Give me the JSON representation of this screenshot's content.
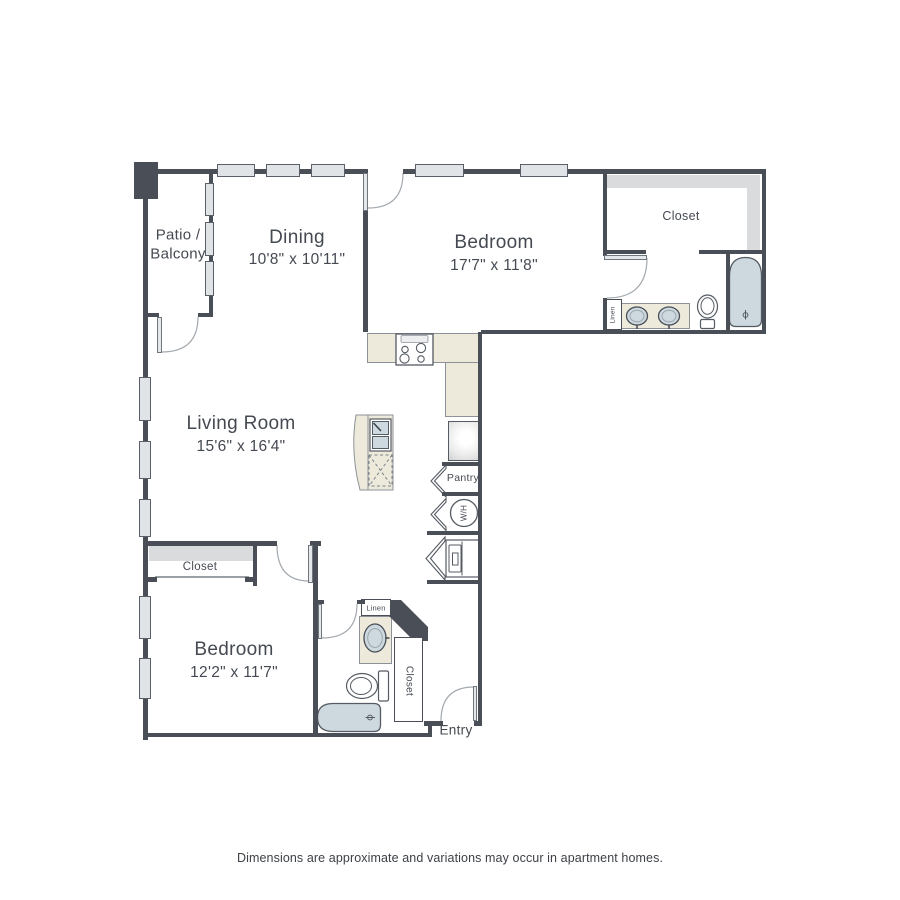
{
  "colors": {
    "wall": "#4a4f57",
    "counter": "#edeadb",
    "fixture": "#cdd8df",
    "shade": "#dadbdd",
    "window": "#e0e4e7",
    "text": "#454a52",
    "arc": "#a3a9af"
  },
  "rooms": {
    "patio": {
      "name_line1": "Patio /",
      "name_line2": "Balcony"
    },
    "dining": {
      "name": "Dining",
      "dims": "10'8\" x 10'11\""
    },
    "bedroom_upper": {
      "name": "Bedroom",
      "dims": "17'7\" x 11'8\""
    },
    "living": {
      "name": "Living Room",
      "dims": "15'6\" x 16'4\""
    },
    "bedroom_lower": {
      "name": "Bedroom",
      "dims": "12'2\" x 11'7\""
    }
  },
  "labels": {
    "closet_upper": "Closet",
    "closet_lower": "Closet",
    "closet_entry": "Closet",
    "linen_upper": "Linen",
    "linen_lower": "Linen",
    "pantry": "Pantry",
    "water_heater": "W/H",
    "entry": "Entry"
  },
  "footer": {
    "disclaimer": "Dimensions are approximate and variations may occur in apartment homes."
  }
}
